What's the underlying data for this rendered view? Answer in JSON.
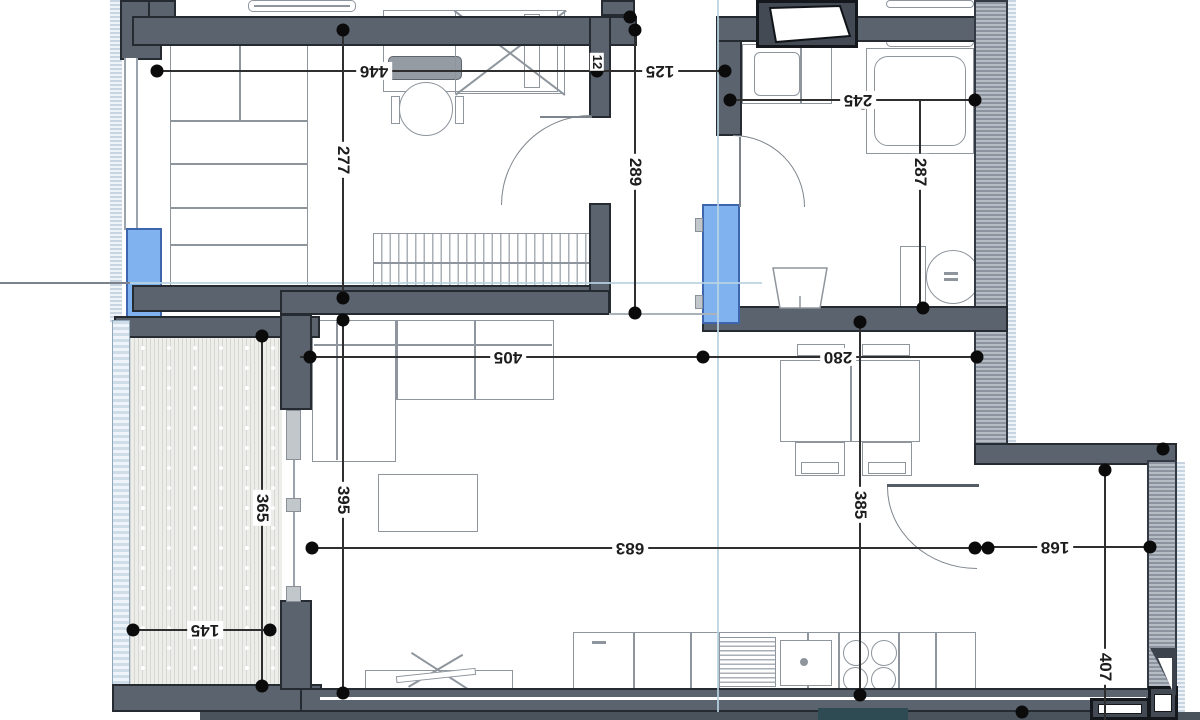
{
  "dimensions": {
    "bedroom_width": "446",
    "bedroom_depth": "277",
    "hall_width": "125",
    "hall_depth": "289",
    "wall_thickness": "12",
    "bathroom_width": "245",
    "bathroom_depth": "287",
    "living_width_left": "405",
    "dining_width": "280",
    "balcony_depth": "365",
    "balcony_width": "145",
    "living_depth_left": "395",
    "living_total_width": "683",
    "dining_depth": "385",
    "entry_niche_width": "168",
    "entry_niche_depth": "407"
  },
  "colors": {
    "interior_wall": "#5b636e",
    "exterior_wall_hatch": "#8d949f",
    "window_blue": "#7fb2ef",
    "railing_blue": "#cfdde9",
    "balcony_floor": "#ededea",
    "dimension_ink": "#0b0b0b",
    "furniture_stroke": "#8e959d",
    "section_line": "#b9d2e2"
  }
}
